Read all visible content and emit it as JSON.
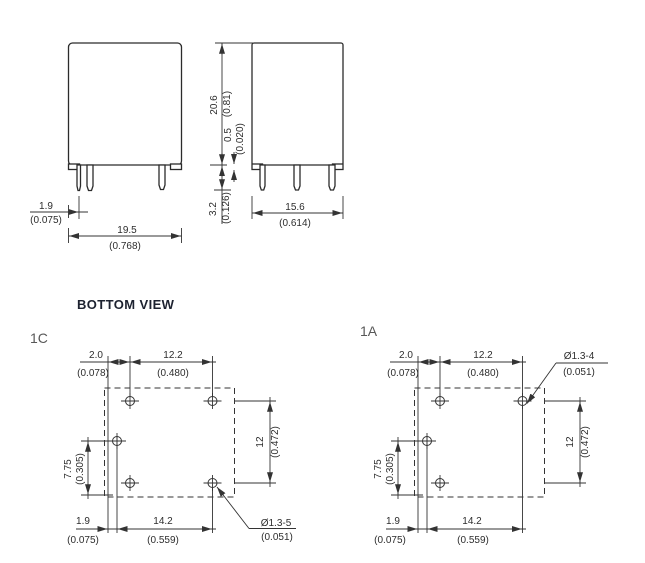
{
  "colors": {
    "line": "#333333",
    "text": "#2d2d2d",
    "title_text": "#1d2230"
  },
  "title": "BOTTOM VIEW",
  "front_view": {
    "pin_offset_mm": "1.9",
    "pin_offset_in": "(0.075)",
    "width_mm": "19.5",
    "width_in": "(0.768)"
  },
  "side_view": {
    "height_mm": "20.6",
    "height_in": "(0.81)",
    "standoff_mm": "0.5",
    "standoff_in": "(0.020)",
    "pin_length_mm": "3.2",
    "pin_length_in": "(0.126)",
    "depth_mm": "15.6",
    "depth_in": "(0.614)"
  },
  "view_1c": {
    "label": "1C",
    "edge_offset_mm": "2.0",
    "edge_offset_in": "(0.078)",
    "top_span_mm": "12.2",
    "top_span_in": "(0.480)",
    "left_span_mm": "7.75",
    "left_span_in": "(0.305)",
    "right_span_mm": "12",
    "right_span_in": "(0.472)",
    "bottom_offset_mm": "1.9",
    "bottom_offset_in": "(0.075)",
    "bottom_span_mm": "14.2",
    "bottom_span_in": "(0.559)",
    "hole_dia": "Ø1.3-5",
    "hole_dia_in": "(0.051)"
  },
  "view_1a": {
    "label": "1A",
    "edge_offset_mm": "2.0",
    "edge_offset_in": "(0.078)",
    "top_span_mm": "12.2",
    "top_span_in": "(0.480)",
    "left_span_mm": "7.75",
    "left_span_in": "(0.305)",
    "right_span_mm": "12",
    "right_span_in": "(0.472)",
    "bottom_offset_mm": "1.9",
    "bottom_offset_in": "(0.075)",
    "bottom_span_mm": "14.2",
    "bottom_span_in": "(0.559)",
    "hole_dia": "Ø1.3-4",
    "hole_dia_in": "(0.051)"
  }
}
